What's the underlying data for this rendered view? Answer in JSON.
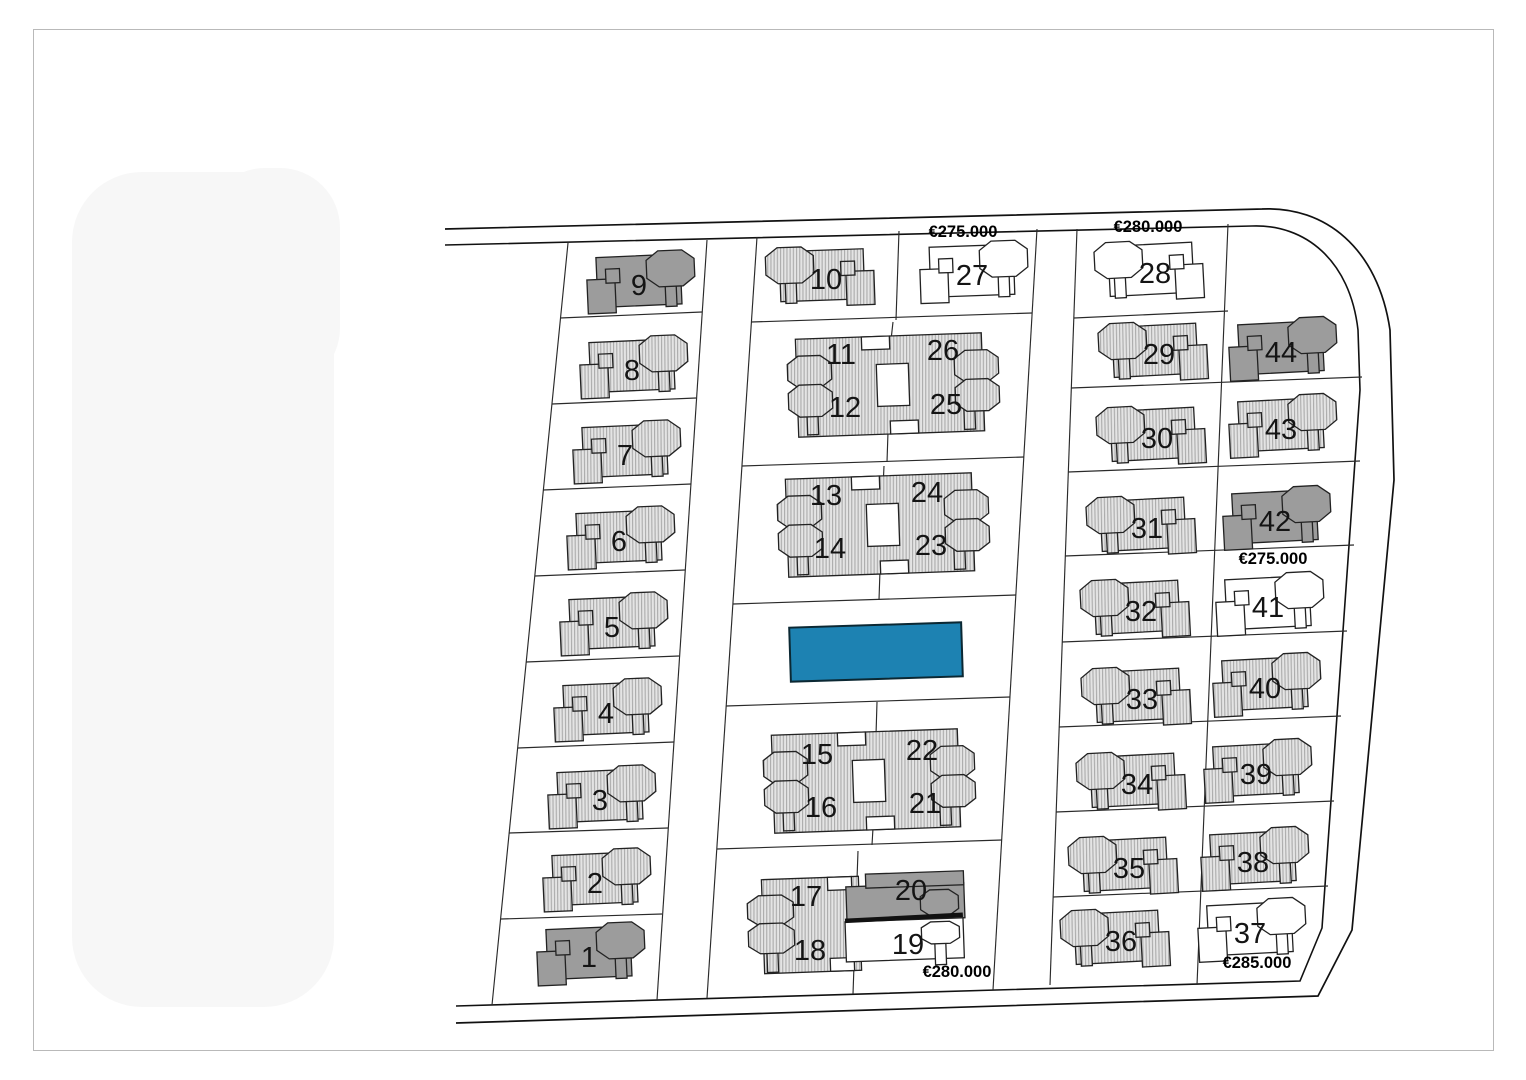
{
  "plan": {
    "pool_color": "#1d82b2",
    "house_fill_hatched": "#e4e4e4",
    "house_hatch_stripe": "#ababab",
    "house_fill_sold_gray": "#9c9c9c",
    "house_fill_white": "#ffffff",
    "outline_color": "#222222"
  },
  "lots": {
    "1": {
      "number": "1",
      "style": "gray"
    },
    "2": {
      "number": "2",
      "style": "hatched"
    },
    "3": {
      "number": "3",
      "style": "hatched"
    },
    "4": {
      "number": "4",
      "style": "hatched"
    },
    "5": {
      "number": "5",
      "style": "hatched"
    },
    "6": {
      "number": "6",
      "style": "hatched"
    },
    "7": {
      "number": "7",
      "style": "hatched"
    },
    "8": {
      "number": "8",
      "style": "hatched"
    },
    "9": {
      "number": "9",
      "style": "gray"
    },
    "10": {
      "number": "10",
      "style": "hatched"
    },
    "11": {
      "number": "11",
      "style": "hatched"
    },
    "12": {
      "number": "12",
      "style": "hatched"
    },
    "13": {
      "number": "13",
      "style": "hatched"
    },
    "14": {
      "number": "14",
      "style": "hatched"
    },
    "15": {
      "number": "15",
      "style": "hatched"
    },
    "16": {
      "number": "16",
      "style": "hatched"
    },
    "17": {
      "number": "17",
      "style": "hatched"
    },
    "18": {
      "number": "18",
      "style": "hatched"
    },
    "19": {
      "number": "19",
      "style": "white",
      "price": "€280.000",
      "price_position": "below"
    },
    "20": {
      "number": "20",
      "style": "gray"
    },
    "21": {
      "number": "21",
      "style": "hatched"
    },
    "22": {
      "number": "22",
      "style": "hatched"
    },
    "23": {
      "number": "23",
      "style": "hatched"
    },
    "24": {
      "number": "24",
      "style": "hatched"
    },
    "25": {
      "number": "25",
      "style": "hatched"
    },
    "26": {
      "number": "26",
      "style": "hatched"
    },
    "27": {
      "number": "27",
      "style": "white",
      "price": "€275.000",
      "price_position": "above"
    },
    "28": {
      "number": "28",
      "style": "white",
      "price": "€280.000",
      "price_position": "above"
    },
    "29": {
      "number": "29",
      "style": "hatched"
    },
    "30": {
      "number": "30",
      "style": "hatched"
    },
    "31": {
      "number": "31",
      "style": "hatched"
    },
    "32": {
      "number": "32",
      "style": "hatched"
    },
    "33": {
      "number": "33",
      "style": "hatched"
    },
    "34": {
      "number": "34",
      "style": "hatched"
    },
    "35": {
      "number": "35",
      "style": "hatched"
    },
    "36": {
      "number": "36",
      "style": "hatched"
    },
    "37": {
      "number": "37",
      "style": "white",
      "price": "€285.000",
      "price_position": "below"
    },
    "38": {
      "number": "38",
      "style": "hatched"
    },
    "39": {
      "number": "39",
      "style": "hatched"
    },
    "40": {
      "number": "40",
      "style": "hatched"
    },
    "41": {
      "number": "41",
      "style": "white",
      "price": "€275.000",
      "price_position": "above"
    },
    "42": {
      "number": "42",
      "style": "gray"
    },
    "43": {
      "number": "43",
      "style": "hatched"
    },
    "44": {
      "number": "44",
      "style": "gray"
    }
  }
}
